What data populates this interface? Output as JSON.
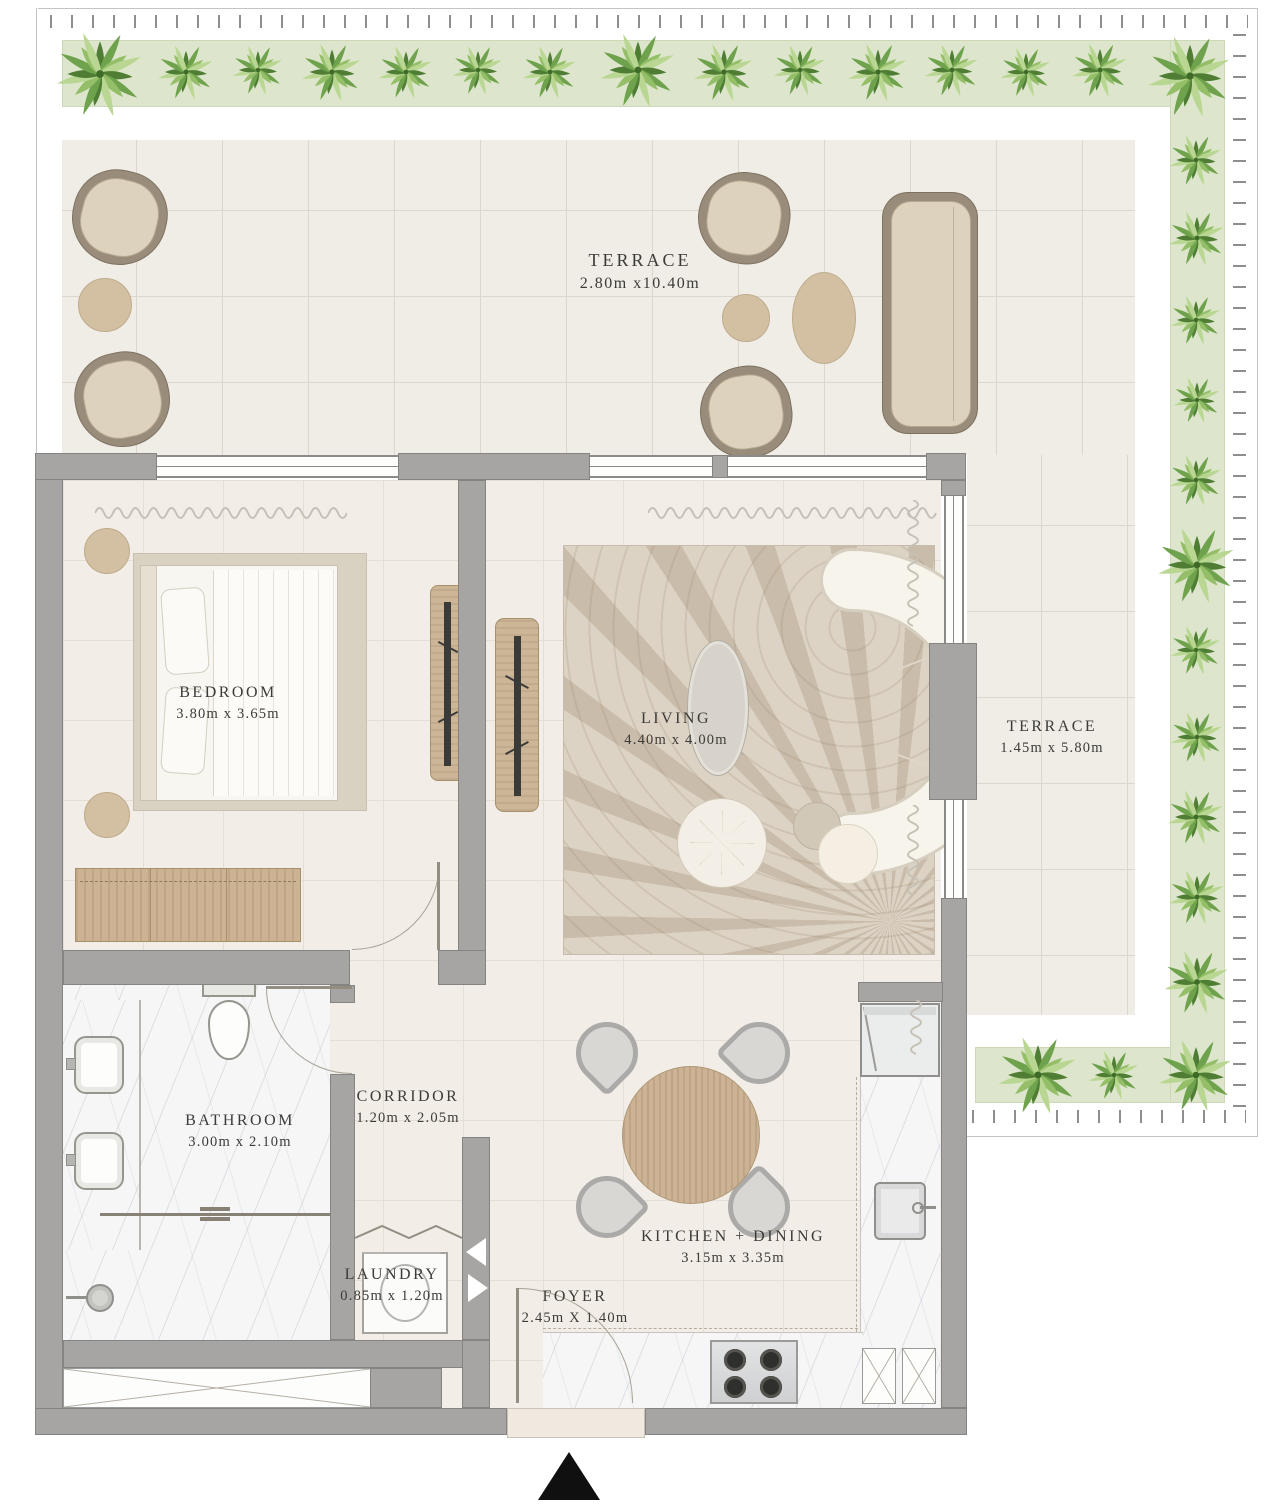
{
  "rooms": {
    "terrace_top": {
      "name": "TERRACE",
      "dims": "2.80m x10.40m"
    },
    "terrace_right": {
      "name": "TERRACE",
      "dims": "1.45m x 5.80m"
    },
    "bedroom": {
      "name": "BEDROOM",
      "dims": "3.80m x 3.65m"
    },
    "living": {
      "name": "LIVING",
      "dims": "4.40m x 4.00m"
    },
    "bathroom": {
      "name": "BATHROOM",
      "dims": "3.00m x 2.10m"
    },
    "corridor": {
      "name": "CORRIDOR",
      "dims": "1.20m x 2.05m"
    },
    "laundry": {
      "name": "LAUNDRY",
      "dims": "0.85m x 1.20m"
    },
    "foyer": {
      "name": "FOYER",
      "dims": "2.45m X 1.40m"
    },
    "kitchen_dining": {
      "name": "KITCHEN + DINING",
      "dims": "3.15m x 3.35m"
    }
  },
  "icons": {
    "north_arrow": "triangle-up",
    "plant": "shrub-top-view"
  },
  "colors": {
    "wall": "#a6a5a3",
    "green_strip": "#dde6cc",
    "tile": "#f0ece6",
    "label_text": "#3c3b37",
    "wood": "#ccb393",
    "north_arrow": "#101010"
  }
}
